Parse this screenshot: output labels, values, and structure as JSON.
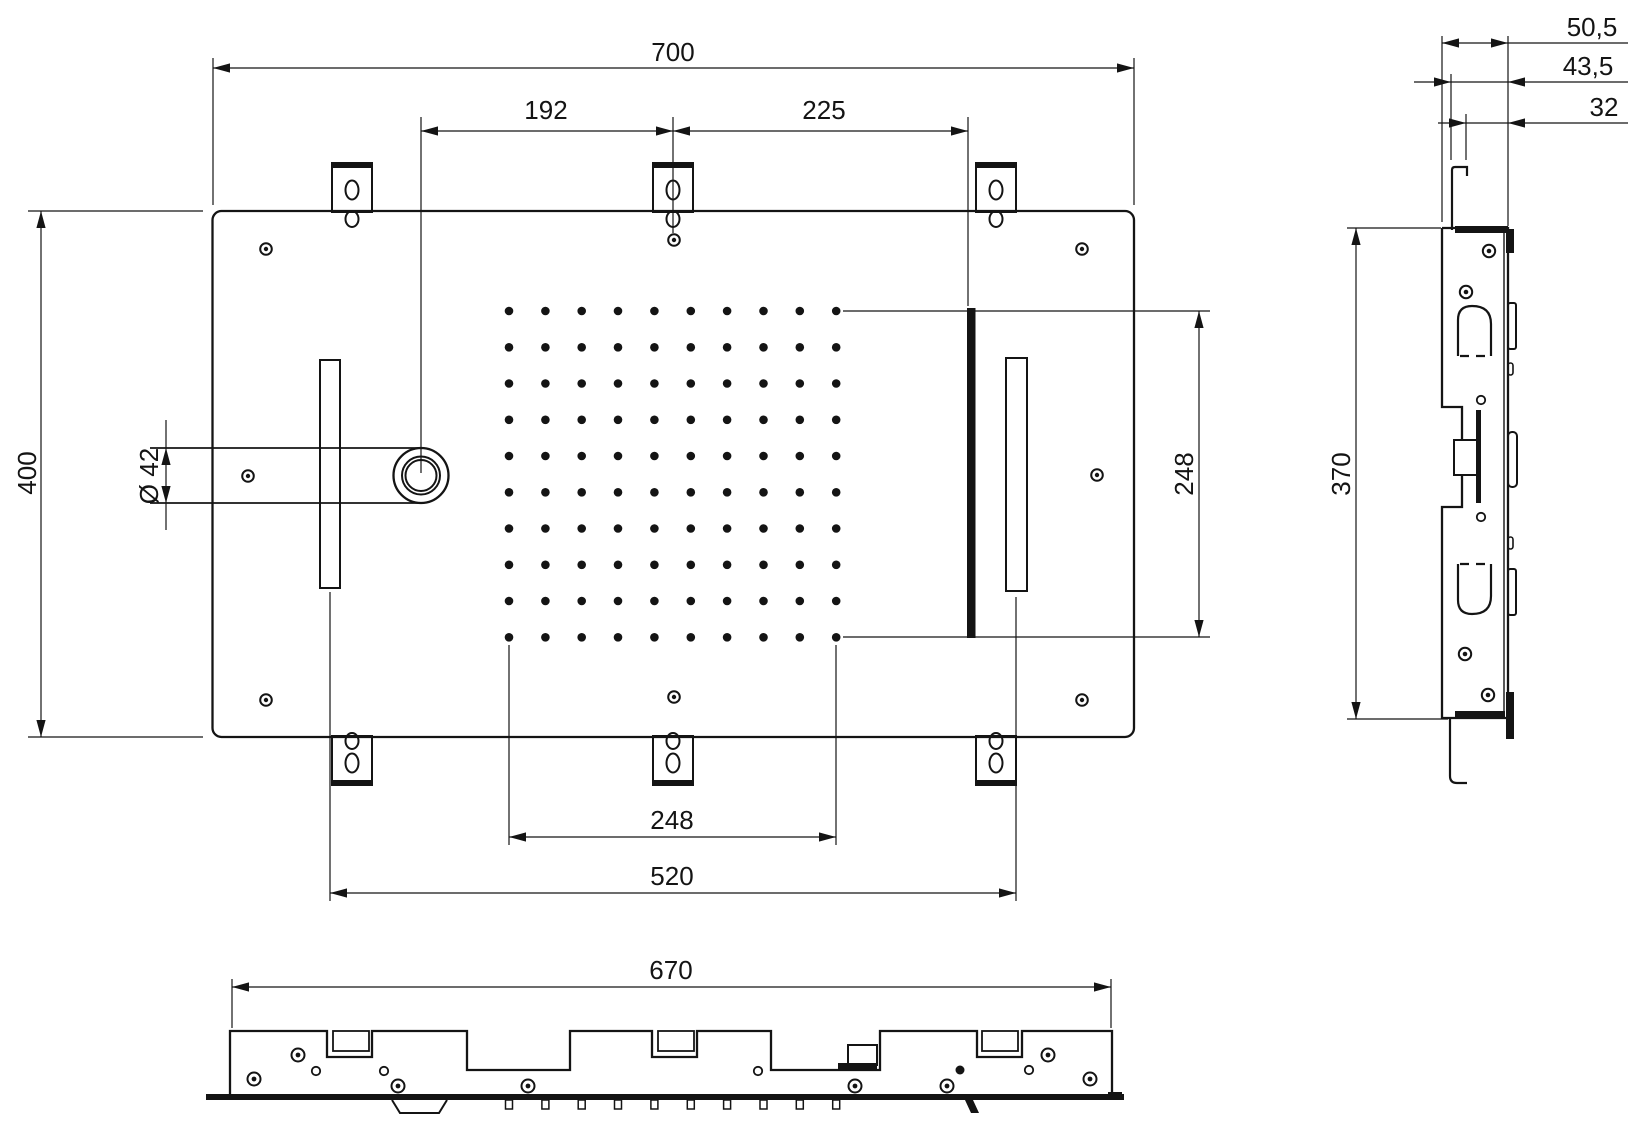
{
  "dimensions": {
    "plan": {
      "overall_width": "700",
      "inlet_to_center": "192",
      "center_to_waterfall": "225",
      "overall_height": "400",
      "inlet_diameter": "Ø 42",
      "nozzle_field_width": "248",
      "nozzle_field_height": "248",
      "slot_spacing": "520"
    },
    "bottom_view": {
      "overall_width": "670"
    },
    "side_view": {
      "total_depth": "50,5",
      "flange_depth": "43,5",
      "hook_depth": "32",
      "bracket_height": "370"
    }
  },
  "nozzle_grid": {
    "rows": 10,
    "columns": 10
  }
}
